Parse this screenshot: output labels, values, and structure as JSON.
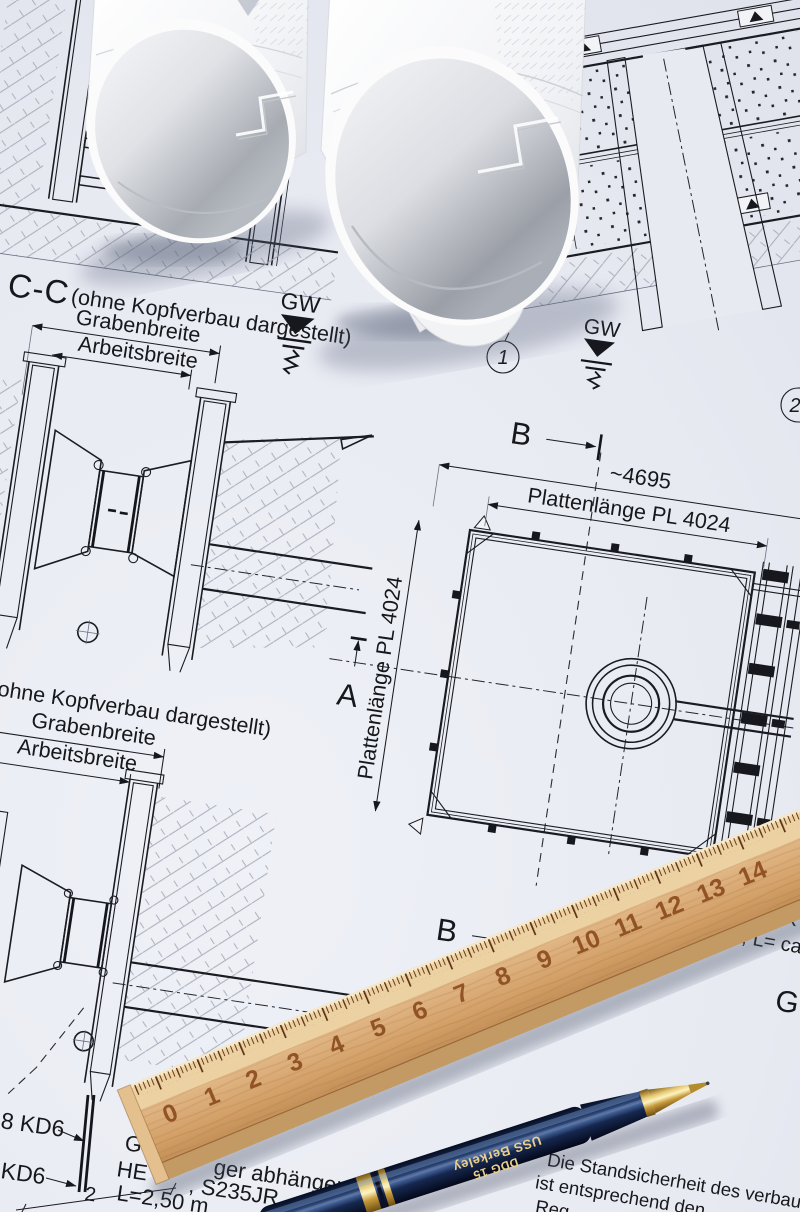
{
  "colors": {
    "paper": "#e8eaf2",
    "ink": "#1a1c22",
    "hatch_gray": "#a9aebb",
    "wood_light": "#eed7ab",
    "wood_mid": "#d6a66e",
    "wood_dark": "#a86f3c",
    "ruler_digits": "#8a4a1d",
    "pen_navy": "#14264d",
    "pen_gold": "#c9a23c",
    "roll_white": "#f7f8fa",
    "roll_shade": "#9ea3ab"
  },
  "section_cc": {
    "title": "C-C",
    "note": "(ohne Kopfverbau dargestellt)",
    "dim_outer": "Grabenbreite",
    "dim_inner": "Arbeitsbreite",
    "gw": "GW"
  },
  "section_lower": {
    "note": "ohne Kopfverbau dargestellt)",
    "dim_outer": "Grabenbreite",
    "dim_inner": "Arbeitsbreite"
  },
  "plan": {
    "marker_top": "B",
    "marker_bottom": "B",
    "marker_left": "A",
    "dim_overall": "~4695",
    "dim_plate_top": "Plattenlänge PL 4024",
    "dim_plate_left": "Plattenlänge PL 4024",
    "callout_1": "1",
    "callout_2": "2",
    "gw": "GW"
  },
  "notes_left": {
    "kd6_a": "8 KD6",
    "kd6_b": "KD6",
    "dim_2": "2"
  },
  "notes_center": {
    "line1_left": "G",
    "line1_right": "ger abhängen",
    "line2_left": "HE",
    "line2_right": ", S235JR",
    "line3": "L=2,50 m"
  },
  "notes_right": {
    "line1": "Die Standsicherheit des verbauten",
    "line2": "ist entsprechend den",
    "line3": "Reg"
  },
  "edge_right": {
    "frag1": "K",
    "frag2": ", L= ca.4",
    "frag3": "G"
  },
  "ruler": {
    "numbers": [
      "0",
      "1",
      "2",
      "3",
      "4",
      "5",
      "6",
      "7",
      "8",
      "9",
      "10",
      "11",
      "12",
      "13",
      "14"
    ]
  },
  "pen": {
    "brand_line1": "USS Berkeley",
    "brand_line2": "DDG 15"
  }
}
